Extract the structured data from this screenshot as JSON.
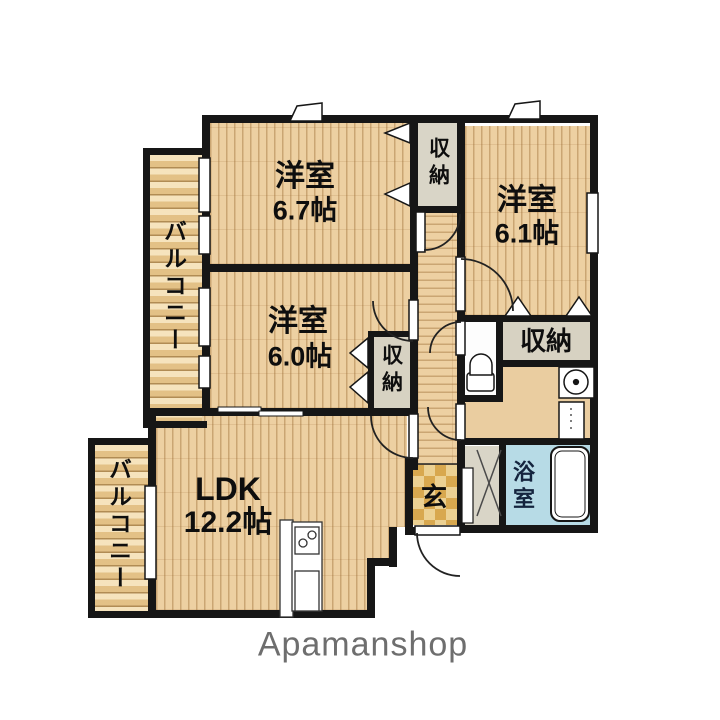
{
  "plan": {
    "rooms": {
      "bedroom_top_left": {
        "name": "洋室",
        "size": "6.7帖"
      },
      "bedroom_top_right": {
        "name": "洋室",
        "size": "6.1帖"
      },
      "bedroom_mid": {
        "name": "洋室",
        "size": "6.0帖"
      },
      "ldk": {
        "name": "LDK",
        "size": "12.2帖"
      },
      "bath": {
        "label": "浴室"
      },
      "entrance": {
        "label": "玄"
      }
    },
    "closets": {
      "top": {
        "label": "収納"
      },
      "mid": {
        "label": "収納"
      },
      "right": {
        "label": "収納"
      }
    },
    "balconies": {
      "upper": {
        "label": "バルコニー"
      },
      "lower": {
        "label": "バルコニー"
      }
    }
  },
  "branding": {
    "logo": "Apamanshop"
  },
  "colors": {
    "wall": "#161616",
    "floor_tan": "#edd0a2",
    "bath_blue": "#b7dbe6",
    "closet_gray": "#d7d2c2",
    "balcony_tan": "#eccf9e",
    "genkan_tile": "#d8a84f",
    "logo_gray": "#6e6e6e"
  }
}
